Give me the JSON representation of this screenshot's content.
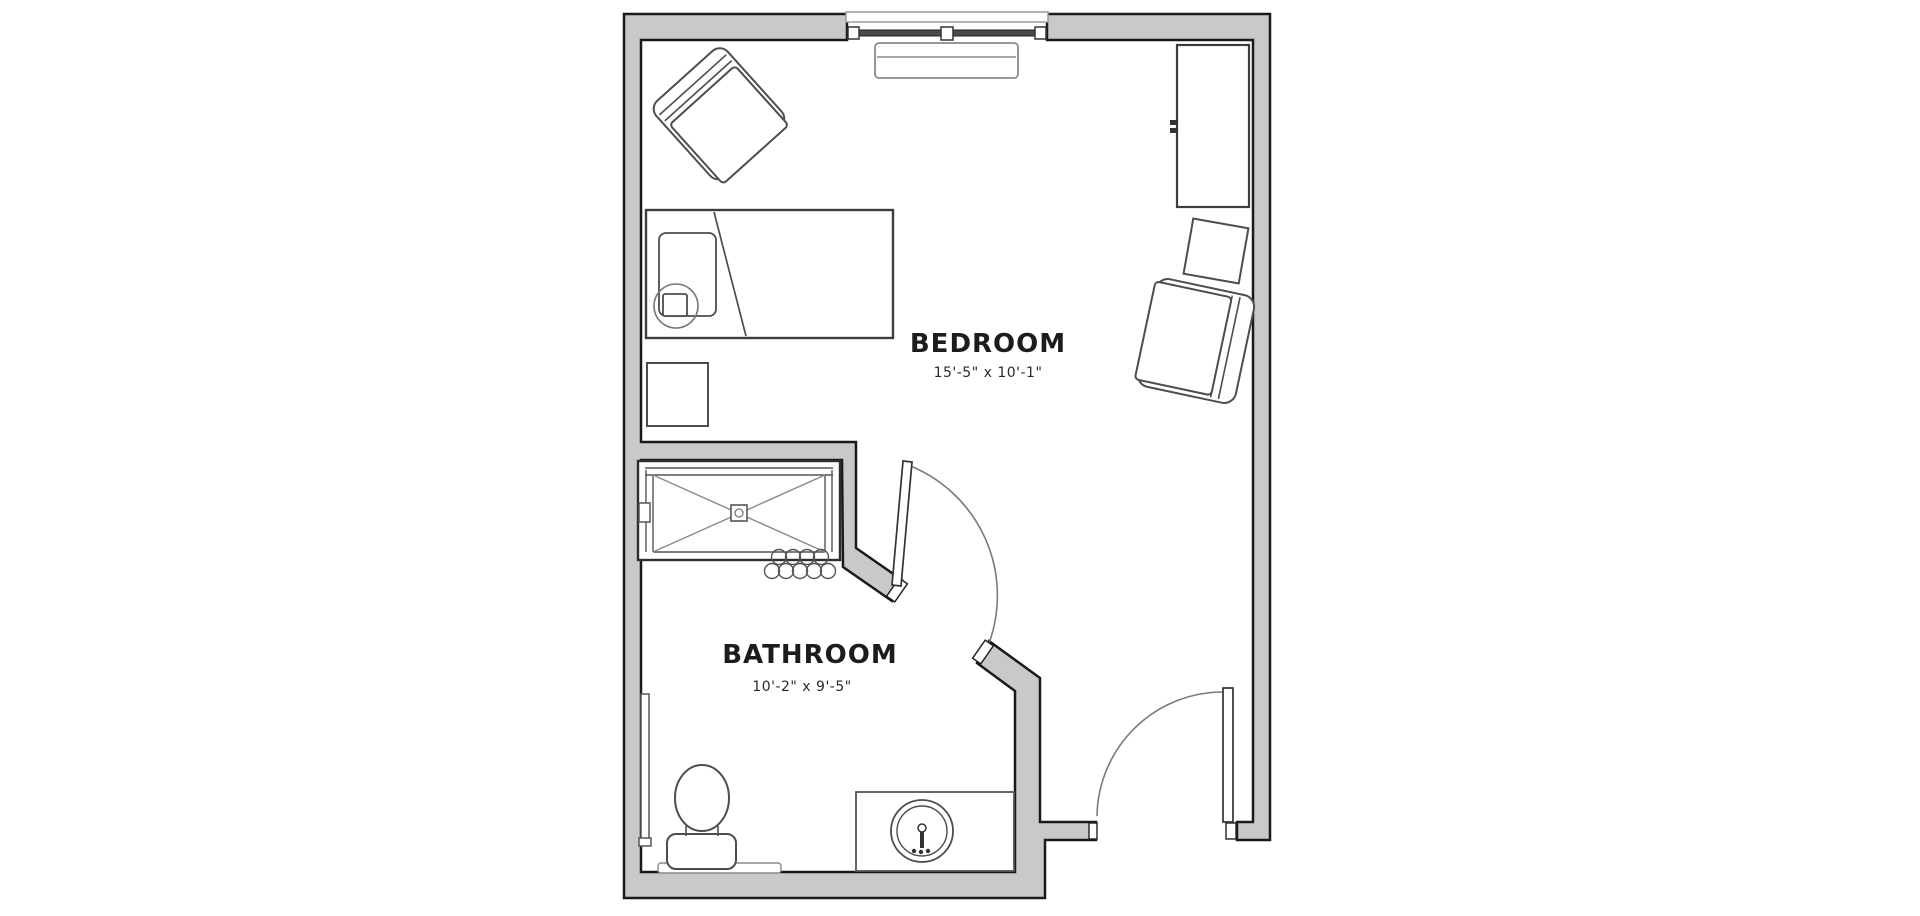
{
  "title": "Studio suite floor plan",
  "rooms": {
    "bedroom": {
      "label": "BEDROOM",
      "dimensions": "15'-5\" x 10'-1\""
    },
    "bathroom": {
      "label": "BATHROOM",
      "dimensions": "10'-2\" x 9'-5\""
    }
  },
  "colors": {
    "background": "#ffffff",
    "wall_fill": "#c9c9c9",
    "wall_outline": "#1a1a1a",
    "furniture_line": "#4d4d4d",
    "light_line": "#8a8a8a",
    "text": "#1c1c1c"
  },
  "fixtures": [
    "bed",
    "pillow",
    "nightstand",
    "lounge-chair",
    "window",
    "console-table",
    "wardrobe",
    "side-table",
    "armchair",
    "shower",
    "shower-drain",
    "shower-curtain-rings",
    "toilet",
    "grab-bar",
    "vanity",
    "sink",
    "bathroom-door",
    "entry-door"
  ]
}
